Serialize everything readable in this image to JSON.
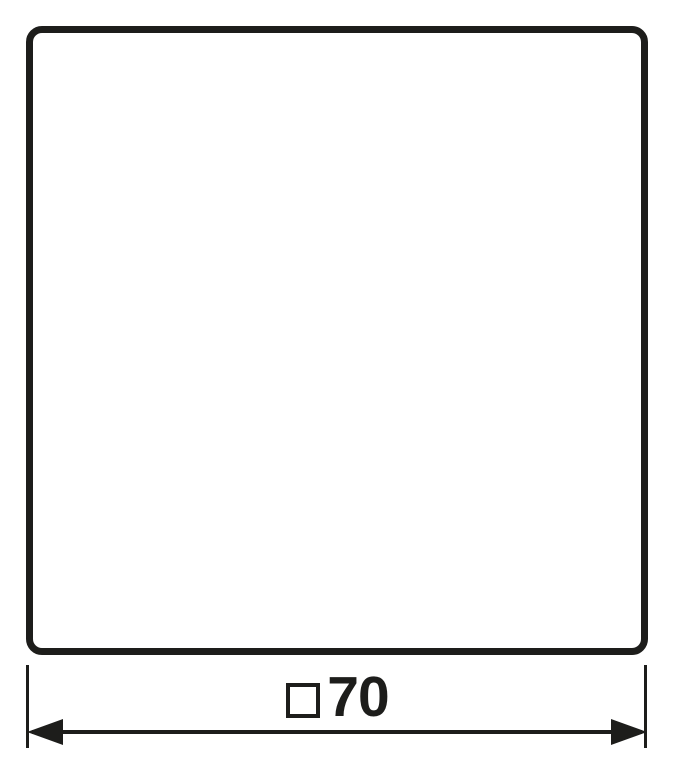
{
  "colors": {
    "line": "#1d1d1b",
    "background": "#ffffff"
  },
  "drawing": {
    "shape": "rounded-square-outline",
    "dimension": {
      "symbol": "□",
      "value": "70",
      "label": "□70"
    }
  }
}
